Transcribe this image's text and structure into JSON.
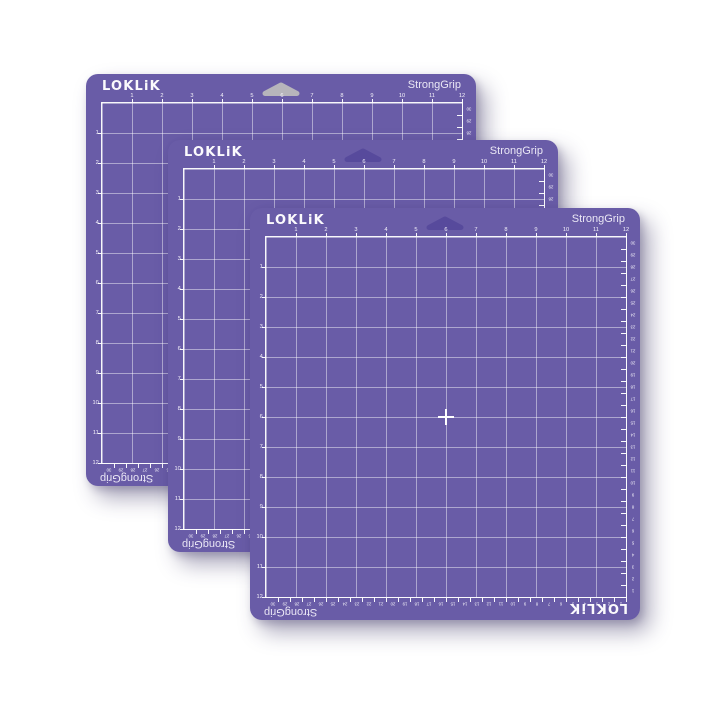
{
  "product": {
    "brand": "LOKLiK",
    "grip_label": "StrongGrip"
  },
  "colors": {
    "background": "#ffffff",
    "mat": "#695ca7",
    "grid_line": "rgba(255,255,255,0.45)",
    "grid_border": "rgba(255,255,255,0.95)",
    "label_text": "#eae7f5",
    "hole_gray": "#b7b5bb",
    "hole_purple": "#574a9c"
  },
  "rulers": {
    "inch_top": [
      "1",
      "2",
      "3",
      "4",
      "5",
      "6",
      "7",
      "8",
      "9",
      "10",
      "11",
      "12"
    ],
    "inch_left": [
      "1",
      "2",
      "3",
      "4",
      "5",
      "6",
      "7",
      "8",
      "9",
      "10",
      "11",
      "12"
    ],
    "cm_right": [
      "30",
      "29",
      "28",
      "27",
      "26",
      "25",
      "24",
      "23",
      "22",
      "21",
      "20",
      "19",
      "18",
      "17",
      "16",
      "15",
      "14",
      "13",
      "12",
      "11",
      "10",
      "9",
      "8",
      "7",
      "6",
      "5",
      "4",
      "3",
      "2",
      "1"
    ],
    "cm_bottom": [
      "30",
      "29",
      "28",
      "27",
      "26",
      "25",
      "24",
      "23",
      "22",
      "21",
      "20",
      "19",
      "18",
      "17",
      "16",
      "15",
      "14",
      "13",
      "12",
      "11",
      "10",
      "9",
      "8",
      "7",
      "6",
      "5",
      "4",
      "3",
      "2",
      "1"
    ]
  },
  "mats": [
    {
      "name": "back-mat",
      "left": 86,
      "top": 74,
      "hole": "gray"
    },
    {
      "name": "middle-mat",
      "left": 168,
      "top": 140,
      "hole": "purple"
    },
    {
      "name": "front-mat",
      "left": 250,
      "top": 208,
      "hole": "purple"
    }
  ]
}
